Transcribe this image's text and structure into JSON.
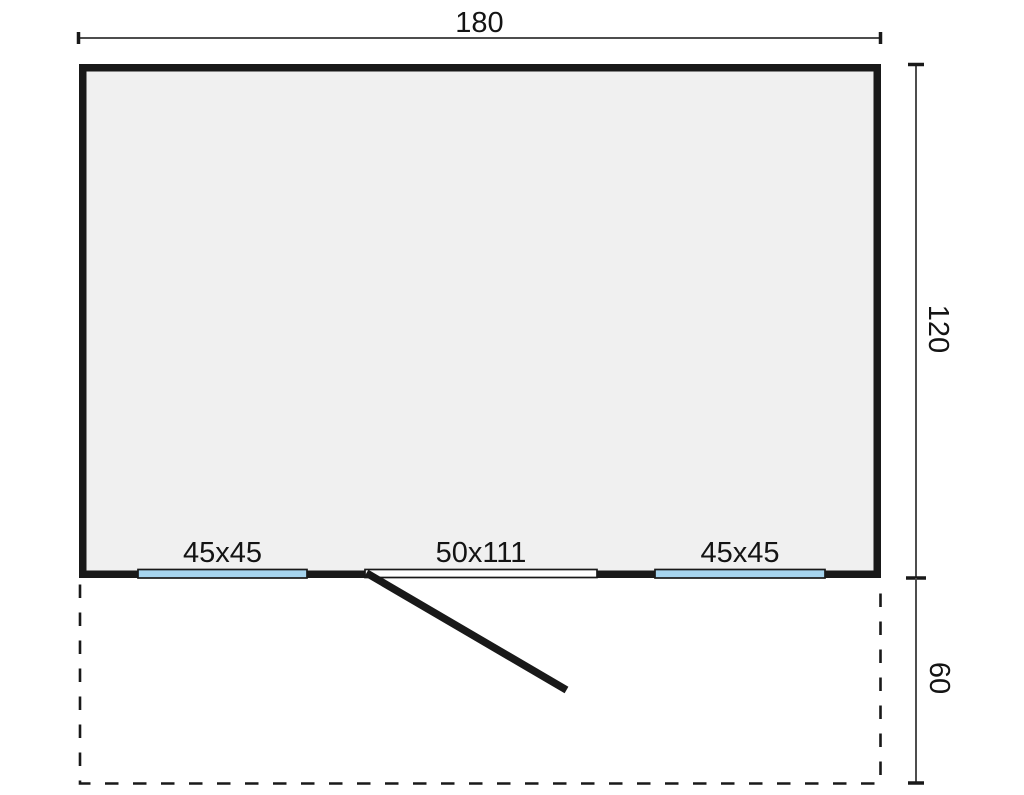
{
  "dimensions": {
    "width_label": "180",
    "depth_label": "120",
    "terrace_depth_label": "60"
  },
  "openings": {
    "window_left_label": "45x45",
    "door_label": "50x111",
    "window_right_label": "45x45"
  },
  "colors": {
    "wall": "#191919",
    "interior": "#f0f0f0",
    "window": "#a6d4ee",
    "door_opening": "#ffffff",
    "dimension_line": "#4d4d4d",
    "text": "#141414",
    "background": "#ffffff"
  }
}
